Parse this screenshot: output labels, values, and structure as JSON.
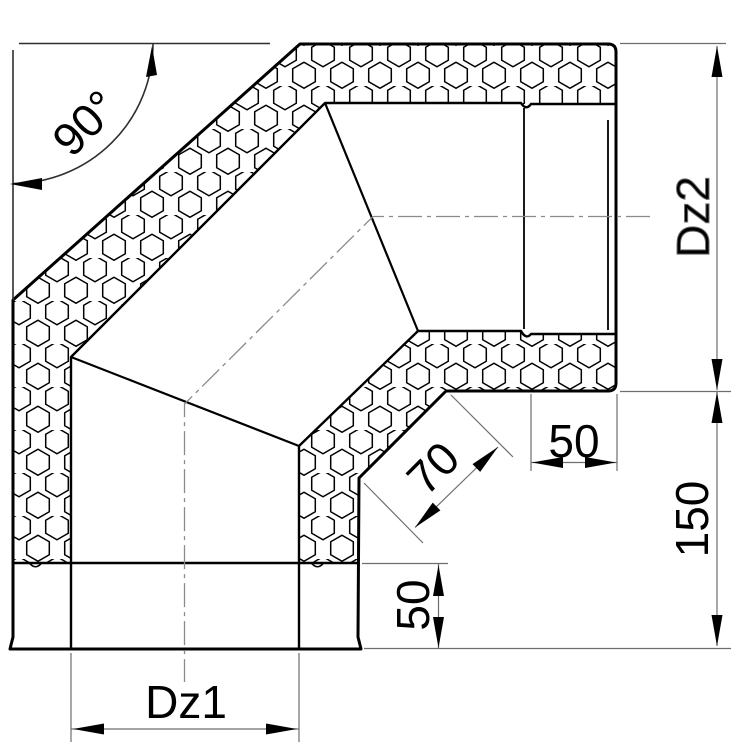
{
  "drawing": {
    "labels": {
      "angle": "90°",
      "outer_diameter": "Dz2",
      "socket_depth_side": "50",
      "segment_width": "70",
      "outlet_offset": "150",
      "socket_depth_bottom": "50",
      "inner_diameter": "Dz1"
    },
    "colors": {
      "line": "#000000",
      "dimension": "#6e6e6e",
      "centerline": "#8a8a8a",
      "background": "#ffffff"
    }
  }
}
